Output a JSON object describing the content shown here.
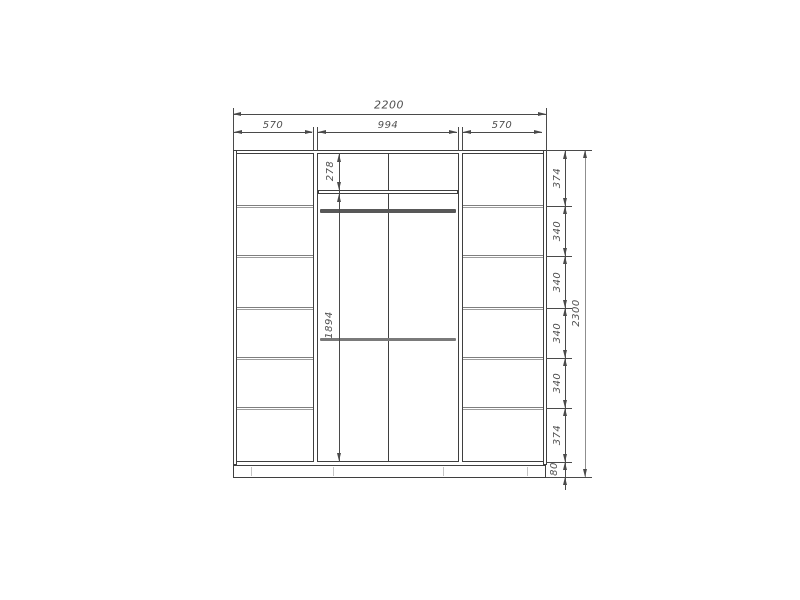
{
  "drawing": {
    "total_width": "2200",
    "top_sections": [
      "570",
      "994",
      "570"
    ],
    "middle_top_height": "278",
    "middle_main_height": "1894",
    "right_sections": [
      "374",
      "340",
      "340",
      "340",
      "340",
      "374",
      "80"
    ],
    "total_height": "2300"
  },
  "colors": {
    "background": "#ffffff",
    "carcass_line": "#3f3f3f",
    "shelf_line": "#7f7f7f",
    "dimension_line": "#4a4a4a",
    "label_text": "#4f4f4f"
  }
}
